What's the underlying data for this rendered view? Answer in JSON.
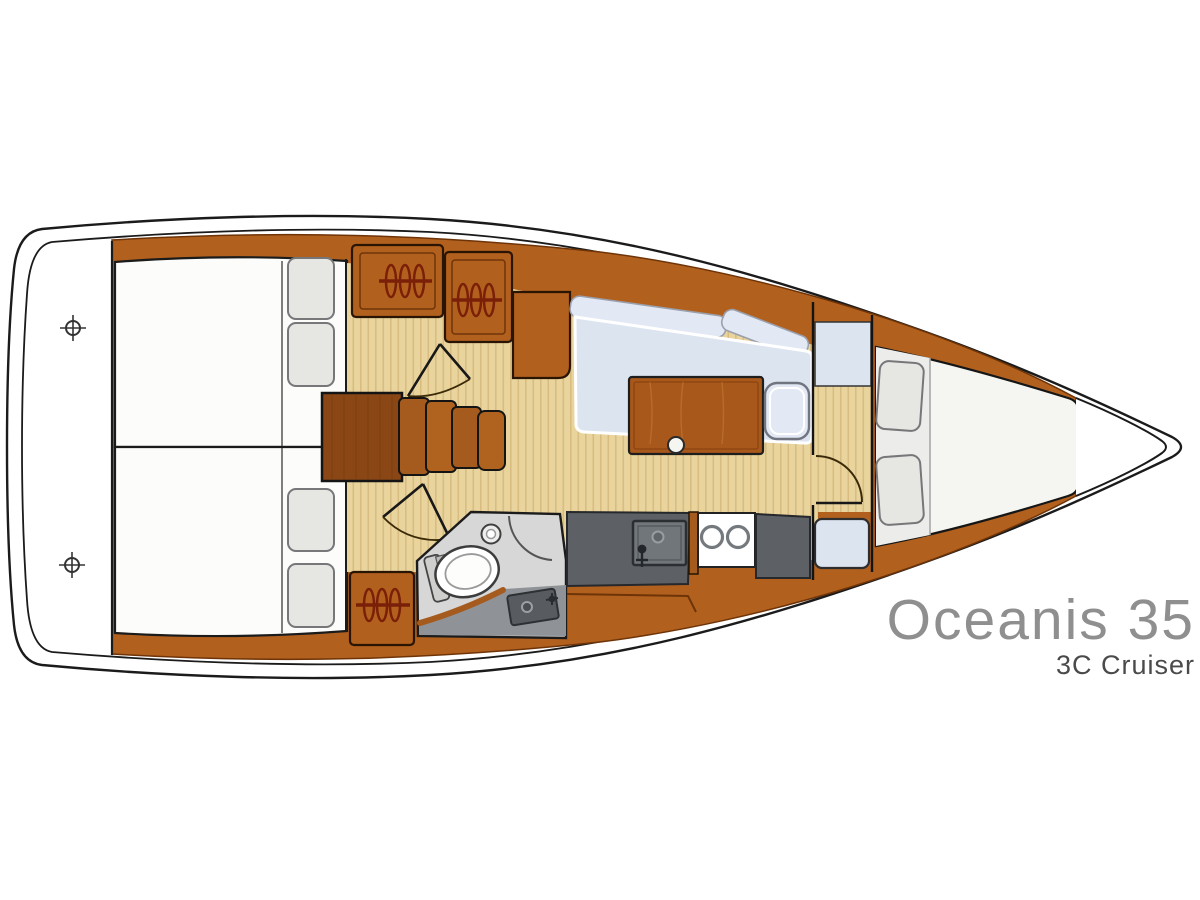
{
  "title": {
    "model": "Oceanis 35",
    "version": "3C Cruiser"
  },
  "colors": {
    "outline": "#1b1b1b",
    "wood": "#b2601e",
    "wood-dark": "#8a4715",
    "wood-deep": "#6e3408",
    "wood-step": "#a55a1e",
    "wood-step2": "#b0621f",
    "wood-table": "#a9581b",
    "floor": "#e9d49d",
    "floor-stripe": "#d9bd80",
    "berth": "#fcfcfb",
    "mattress": "#f5f5f2",
    "mattress-head": "#ececе9",
    "pillow": "#e6e6e3",
    "pillow-border": "#77777a",
    "cushion": "#dce4f0",
    "cushion-light": "#e3e9f4",
    "counter": "#5d6165",
    "counter-edge": "#26282b",
    "sink": "#71767b",
    "head-floor": "#d7d7d7",
    "vanity": "#8f9397",
    "basin": "#585c60",
    "hanger": "#7a2008",
    "door": "#3a2a08",
    "title-gray": "#8f8f8f",
    "subtitle-dark": "#4a4a4a"
  },
  "icons": {
    "deck_fitting": "crosshair-circle",
    "hanging_locker": "hanger-coils-on-bar",
    "door_swing": "quarter-arc",
    "cup_holder": "white-circle",
    "burner": "ring-circle"
  }
}
